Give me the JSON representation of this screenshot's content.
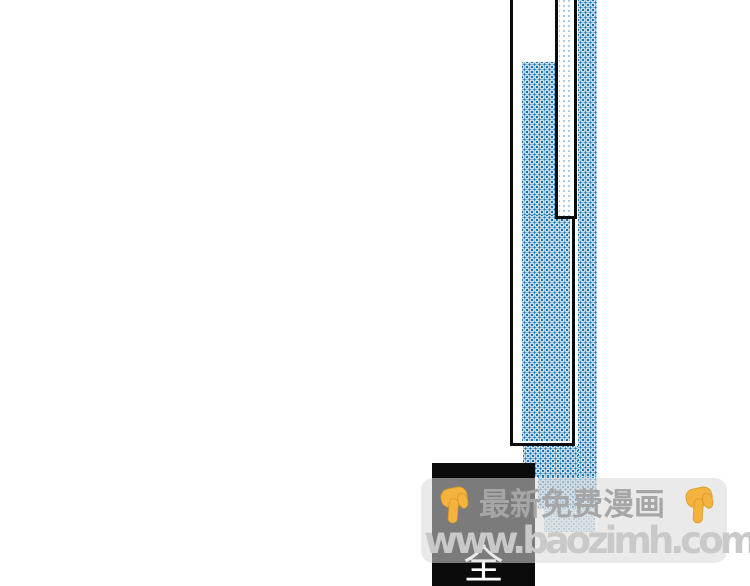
{
  "colors": {
    "page-bg": "#ffffff",
    "panel-border": "#0b0b0b",
    "dot-dark": "#1b70a9",
    "dot-light": "#9cc5e0",
    "next-panel-bg": "#0b0b0b",
    "caption-color": "#ffffff",
    "overlay": "#d9d9d9",
    "title-color": "#a6a6a6",
    "url-color": "#c9c9c9",
    "emoji-fill": "#f3b33e",
    "emoji-outline": "#d79a26"
  },
  "comic": {
    "panel_caption": "全",
    "shading_style": "blue-halftone-dots"
  },
  "watermark": {
    "title": "最新免费漫画",
    "url": "www.baozimh.com",
    "left_icon": "backhand-index-pointing-down",
    "right_icon": "backhand-index-pointing-down"
  }
}
